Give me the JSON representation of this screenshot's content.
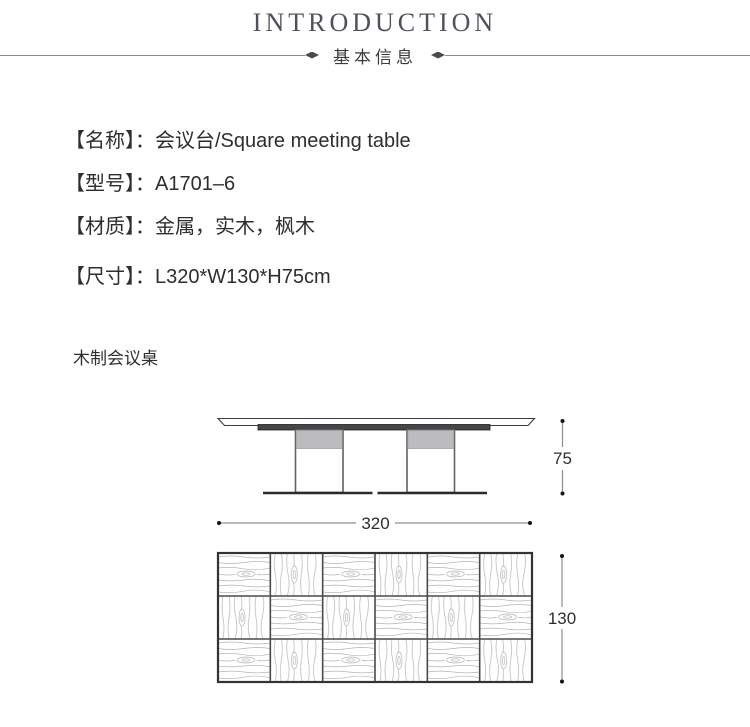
{
  "header": {
    "title": "INTRODUCTION",
    "subtitle": "基本信息"
  },
  "specs": {
    "items": [
      {
        "text": "【名称】：会议台/Square meeting table"
      },
      {
        "text": "【型号】：A1701–6"
      },
      {
        "text": "【材质】：金属，实木，枫木"
      },
      {
        "text": "【尺寸】：L320*W130*H75cm"
      }
    ]
  },
  "drawing": {
    "caption": "木制会议桌",
    "front_view": {
      "height_label": "75",
      "width_label": "320"
    },
    "top_view": {
      "depth_label": "130",
      "grid": {
        "cols": 6,
        "rows": 3,
        "orientations": [
          [
            "h",
            "v",
            "h",
            "v",
            "h",
            "v"
          ],
          [
            "v",
            "h",
            "v",
            "h",
            "v",
            "h"
          ],
          [
            "h",
            "v",
            "h",
            "v",
            "h",
            "v"
          ]
        ]
      }
    }
  },
  "colors": {
    "accent_dark": "#2e2e2e",
    "line_gray": "#8c8c8c",
    "apron_fill": "#46464a",
    "leg_band": "#bcbcbf",
    "grain": "#b4b4b4"
  }
}
